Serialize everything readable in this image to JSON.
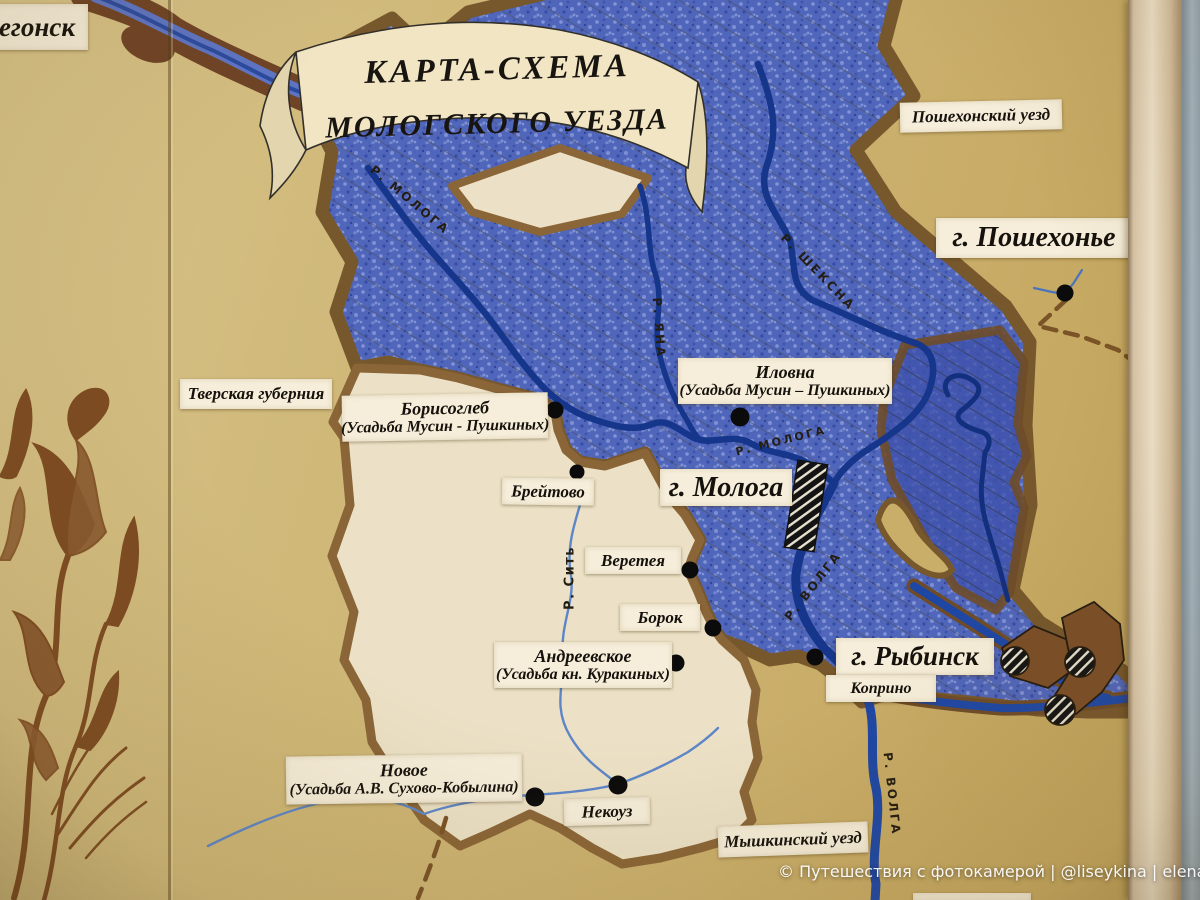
{
  "banner": {
    "line1": "КАРТА-СХЕМА",
    "line2": "МОЛОГСКОГО УЕЗДА"
  },
  "areas": {
    "vesyegonsk_partial": "егонск",
    "poshekhonsky_uyezd": "Пошехонский уезд",
    "tverskaya_guberniya": "Тверская губерния",
    "myshkinsky_uyezd": "Мышкинский уезд"
  },
  "cities": {
    "poshekhonye": "г. Пошехонье",
    "mologa": "г. Молога",
    "rybinsk": "г. Рыбинск"
  },
  "settlements": {
    "borisogleb": {
      "name": "Борисоглеб",
      "estate": "(Усадьба Мусин - Пушкиных)"
    },
    "ilovna": {
      "name": "Иловна",
      "estate": "(Усадьба Мусин – Пушкиных)"
    },
    "breytovo": "Брейтово",
    "vereteya": "Веретея",
    "borok": "Борок",
    "andreevskoe": {
      "name": "Андреевское",
      "estate": "(Усадьба кн. Куракиных)"
    },
    "koprino": "Коприно",
    "novoe": {
      "name": "Новое",
      "estate": "(Усадьба А.В. Сухово-Кобылина)"
    },
    "nekouz": "Некоуз"
  },
  "rivers": {
    "mologa_upper": "Р. МОЛОГА",
    "sheksna": "Р. ШЕКСНА",
    "yana": "Р. ЯНА",
    "mologa_mid": "Р. МОЛОГА",
    "volga_mid": "Р. ВОЛГА",
    "sit": "Р. Сить",
    "volga_south": "Р. ВОЛГА"
  },
  "watermark": "© Путешествия с фотокамерой | @liseykina | elena@liseykina.ru",
  "colors": {
    "wall_tan": "#cfb877",
    "flood_blue": "#5066bb",
    "river_blue": "#16368c",
    "border_brown": "#77572c",
    "land_cream": "#ece1c6",
    "label_paper": "#f6eeda",
    "ornament_brown": "#7d4b22"
  }
}
